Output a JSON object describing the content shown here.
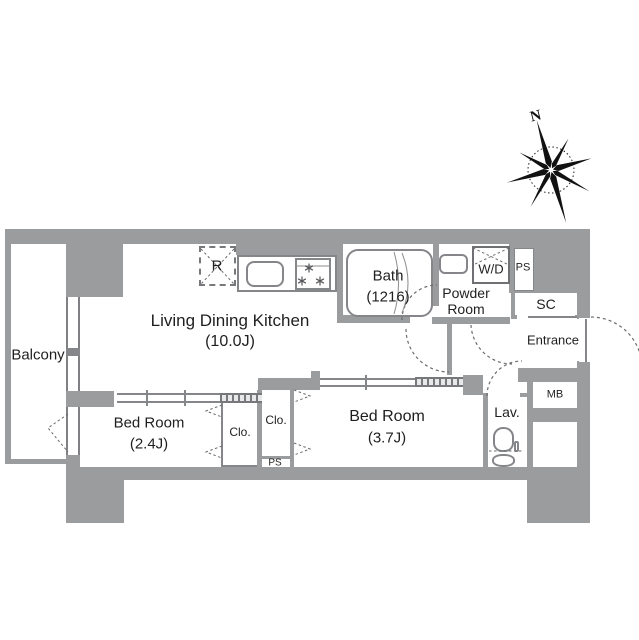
{
  "plan": {
    "type": "apartment-floor-plan",
    "colors": {
      "wall": "#9b9c9e",
      "line": "#85868a",
      "dash": "#6b6c6e",
      "text": "#1f1f1f",
      "background": "#ffffff"
    },
    "compass": {
      "north_label": "N"
    },
    "rooms": {
      "balcony": {
        "label": "Balcony"
      },
      "ldk": {
        "label": "Living Dining Kitchen",
        "size": "(10.0J)"
      },
      "bath": {
        "label": "Bath",
        "size": "(1216)"
      },
      "powder_room": {
        "line1": "Powder",
        "line2": "Room"
      },
      "washer_dryer": {
        "label": "W/D"
      },
      "pipe_space_top": {
        "label": "PS"
      },
      "shoe_closet": {
        "label": "SC"
      },
      "entrance": {
        "label": "Entrance"
      },
      "meter_box": {
        "label": "MB"
      },
      "lavatory": {
        "label": "Lav."
      },
      "bedroom_small": {
        "label": "Bed Room",
        "size": "(2.4J)"
      },
      "closet1": {
        "label": "Clo."
      },
      "closet2": {
        "label": "Clo."
      },
      "pipe_space_bottom": {
        "label": "PS"
      },
      "bedroom_large": {
        "label": "Bed Room",
        "size": "(3.7J)"
      },
      "refrigerator": {
        "label": "R"
      }
    }
  }
}
